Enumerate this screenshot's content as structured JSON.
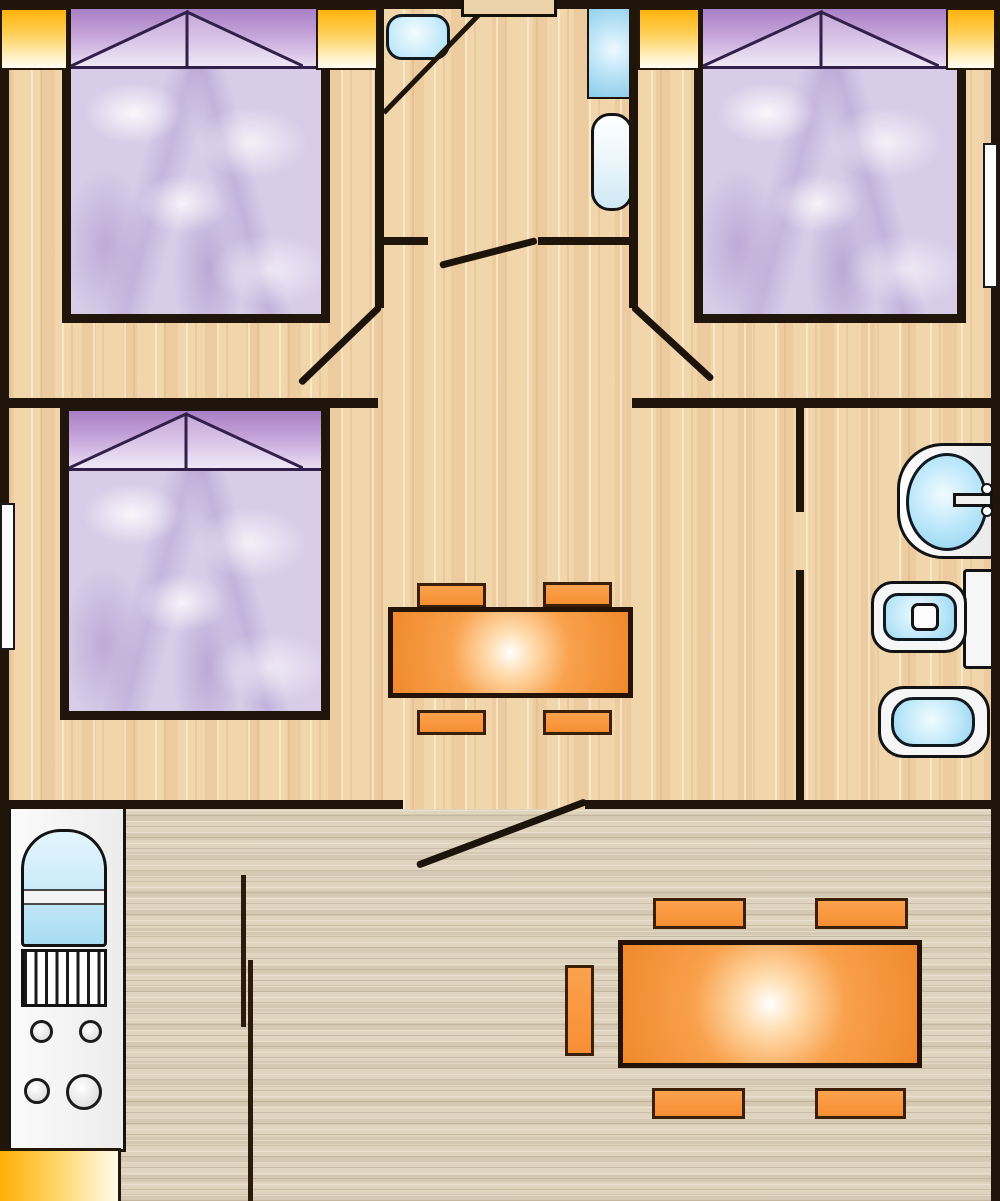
{
  "plan": {
    "kind": "mobile-home floor plan, top-down 2D color drawing, no text labels",
    "zones": {
      "upper_floor_finish": "light maple wood with vertical grain",
      "lower_floor_finish": "pale grey-beige wood with horizontal grain"
    },
    "rooms": [
      {
        "name": "bedroom-top-left",
        "furniture": [
          "double bed with purple headboard and two pillow triangles",
          "lilac marbled mattress"
        ],
        "windows": [
          "corner window left",
          "window right of headboard"
        ]
      },
      {
        "name": "wc-room-top-center",
        "furniture": [
          "corner counter with oval washbasin",
          "shower tray",
          "water-heater column",
          "entry door step"
        ],
        "doors": [
          "open door leaf into hallway"
        ]
      },
      {
        "name": "bedroom-top-right",
        "furniture": [
          "double bed with purple headboard and two pillow triangles"
        ],
        "windows": [
          "window left of headboard",
          "window right of headboard",
          "tall white window on right wall"
        ],
        "doors": [
          "open door leaf from hallway"
        ]
      },
      {
        "name": "bedroom-middle-left",
        "furniture": [
          "double bed with purple headboard"
        ],
        "windows": [
          "tall white window on left wall"
        ],
        "doors": [
          "open door leaf from hallway"
        ]
      },
      {
        "name": "dining-area-middle-center",
        "furniture": [
          "rectangular orange table",
          "4 orange chairs"
        ]
      },
      {
        "name": "bathroom-middle-right",
        "furniture": [
          "pedestal washbasin with faucet and two knobs",
          "toilet with cistern",
          "bidet"
        ]
      },
      {
        "name": "living-kitchen-bottom",
        "furniture": [
          "kitchen unit with arched sink, drainer grill and 4 burners",
          "large rectangular orange table",
          "5 orange chairs",
          "sliding partition lines"
        ],
        "windows": [
          "window strip bottom-left corner"
        ],
        "doors": [
          "open door leaf at center opening"
        ]
      }
    ],
    "counts": {
      "beds": 3,
      "tables": 2,
      "chairs": 9,
      "toilets": 1,
      "bidets": 1,
      "washbasins": 3,
      "showers": 1,
      "windows_orange": 5,
      "windows_white": 2,
      "door_leaves": 4,
      "burners": 4
    },
    "palette": {
      "wall": "#20150b",
      "floor_upper": "#f0d3a9",
      "floor_lower": "#ddd1bc",
      "window_orange_top": "#ffb20d",
      "window_orange_bottom": "#fffdf4",
      "furniture_orange": "#f7973d",
      "table_highlight": "#ffffff",
      "headboard_purple": "#a87fc4",
      "mattress_lilac": "#d8cce8",
      "fixture_blue": "#c8ecfa",
      "fixture_white": "#f6f6f6"
    }
  }
}
